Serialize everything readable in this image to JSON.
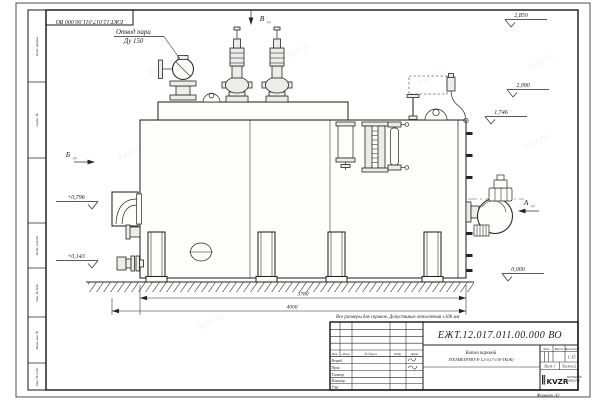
{
  "page": {
    "watermark": "kvzr.ru",
    "format_note": "Формат А3",
    "top_doc_number": "ЕЖТ.12.017.011.00.000  ВО",
    "note": "Все размеры для справок. Допустимые отклонения ±100 мм"
  },
  "side_stamps": [
    "Перв. примен.",
    "Справ. №",
    "",
    "Подп. и дата",
    "Инв. № дубл.",
    "Взам. инв. №",
    "Инв. № подл."
  ],
  "drawing": {
    "steam_outlet_label": [
      "Отвод пара",
      "Ду 150"
    ],
    "view_markers": {
      "top": "В",
      "left": "Б",
      "right": "А"
    },
    "view_sheet_ref": "(2)",
    "elevations": [
      "2,850",
      "2,090",
      "1,746",
      "0,000",
      "+0,796",
      "+0,143"
    ],
    "dimensions": [
      "3780",
      "4000"
    ]
  },
  "title_block": {
    "doc_number": "ЕЖТ.12.017.011.00.000  ВО",
    "name_line1": "Котел паровой",
    "name_line2": "STEAMEXPERT-Е-1,2-0,17-130-ТК(Ж)",
    "col_headers": [
      "Изм.",
      "Лист",
      "№ докум.",
      "Подп.",
      "Дата"
    ],
    "row_labels": [
      "Разраб.",
      "Пров.",
      "Т.контр.",
      "Н.контр.",
      "Утв."
    ],
    "prop_headers": [
      "Лит.",
      "Масса",
      "Масштаб"
    ],
    "scale_value": "1:15",
    "sheet_label": "Лист 1",
    "sheets_label": "Листов 2",
    "logo": {
      "text": "KVZR",
      "sub1": "КОТЕЛЬНЫЙ",
      "sub2": "ЗАВОД РЭП"
    }
  }
}
